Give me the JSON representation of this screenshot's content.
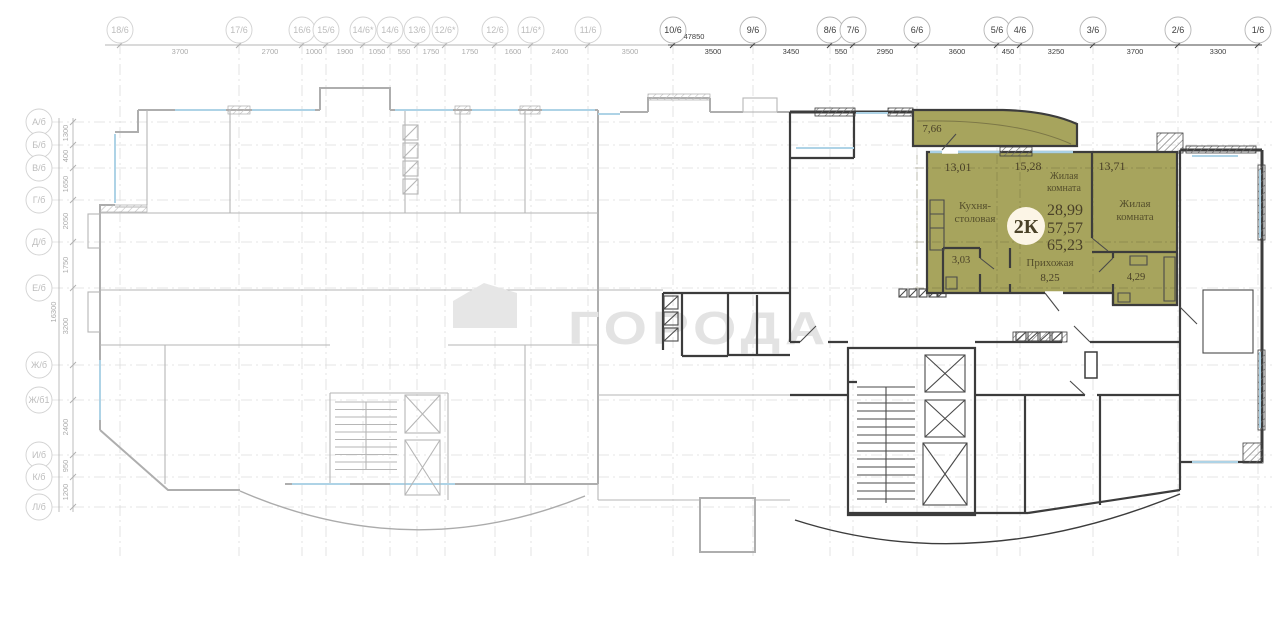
{
  "watermark": {
    "text": "ГОРОДА"
  },
  "colors": {
    "highlight": "#a7a45d",
    "badge_bg": "#fcf5e6",
    "label_text": "#4a4128",
    "glazing": "#aed3e6",
    "walls_dark": "#3c3c3c",
    "walls_gray": "#aeaeae"
  },
  "apartment": {
    "badge": "2К",
    "areas": {
      "living": "28,99",
      "total": "57,57",
      "full": "65,23"
    },
    "rooms": {
      "balcony": {
        "area": "7,66"
      },
      "kitchen": {
        "line1": "Кухня-",
        "line2": "столовая",
        "area": "13,01"
      },
      "living_mid": {
        "line1": "Жилая",
        "line2": "комната",
        "area": "15,28"
      },
      "living_right": {
        "line1": "Жилая",
        "line2": "комната",
        "area": "13,71"
      },
      "hall": {
        "name": "Прихожая",
        "area": "8,25"
      },
      "wc_left": {
        "area": "3,03"
      },
      "wc_right": {
        "area": "4,29"
      }
    }
  },
  "grid": {
    "top_total": "47850",
    "left_total": "16300",
    "top_axes": [
      {
        "label": "18/6",
        "x": 120,
        "dark": false
      },
      {
        "label": "17/6",
        "x": 239,
        "dark": false
      },
      {
        "label": "16/6",
        "x": 302,
        "dark": false
      },
      {
        "label": "15/6",
        "x": 326,
        "dark": false
      },
      {
        "label": "14/6*",
        "x": 363,
        "dark": false
      },
      {
        "label": "14/6",
        "x": 390,
        "dark": false
      },
      {
        "label": "13/6",
        "x": 417,
        "dark": false
      },
      {
        "label": "12/6*",
        "x": 445,
        "dark": false
      },
      {
        "label": "12/6",
        "x": 495,
        "dark": false
      },
      {
        "label": "11/6*",
        "x": 531,
        "dark": false
      },
      {
        "label": "11/6",
        "x": 588,
        "dark": false
      },
      {
        "label": "10/6",
        "x": 673,
        "dark": true
      },
      {
        "label": "9/6",
        "x": 753,
        "dark": true
      },
      {
        "label": "8/6",
        "x": 830,
        "dark": true
      },
      {
        "label": "7/6",
        "x": 853,
        "dark": true
      },
      {
        "label": "6/6",
        "x": 917,
        "dark": true
      },
      {
        "label": "5/6",
        "x": 997,
        "dark": true
      },
      {
        "label": "4/6",
        "x": 1020,
        "dark": true
      },
      {
        "label": "3/6",
        "x": 1093,
        "dark": true
      },
      {
        "label": "2/6",
        "x": 1178,
        "dark": true
      },
      {
        "label": "1/6",
        "x": 1258,
        "dark": true
      }
    ],
    "top_dims": [
      {
        "value": "3700",
        "x": 180,
        "dark": false
      },
      {
        "value": "2700",
        "x": 270,
        "dark": false
      },
      {
        "value": "1000",
        "x": 314,
        "dark": false
      },
      {
        "value": "1900",
        "x": 345,
        "dark": false
      },
      {
        "value": "1050",
        "x": 377,
        "dark": false
      },
      {
        "value": "550",
        "x": 404,
        "dark": false
      },
      {
        "value": "1750",
        "x": 431,
        "dark": false
      },
      {
        "value": "1750",
        "x": 470,
        "dark": false
      },
      {
        "value": "1600",
        "x": 513,
        "dark": false
      },
      {
        "value": "2400",
        "x": 560,
        "dark": false
      },
      {
        "value": "3500",
        "x": 630,
        "dark": false
      },
      {
        "value": "3500",
        "x": 713,
        "dark": true
      },
      {
        "value": "3450",
        "x": 791,
        "dark": true
      },
      {
        "value": "550",
        "x": 841,
        "dark": true
      },
      {
        "value": "2950",
        "x": 885,
        "dark": true
      },
      {
        "value": "3600",
        "x": 957,
        "dark": true
      },
      {
        "value": "450",
        "x": 1008,
        "dark": true
      },
      {
        "value": "3250",
        "x": 1056,
        "dark": true
      },
      {
        "value": "3700",
        "x": 1135,
        "dark": true
      },
      {
        "value": "3300",
        "x": 1218,
        "dark": true
      }
    ],
    "left_axes": [
      {
        "label": "А/б",
        "y": 122
      },
      {
        "label": "Б/б",
        "y": 145
      },
      {
        "label": "В/б",
        "y": 168
      },
      {
        "label": "Г/б",
        "y": 200
      },
      {
        "label": "Д/б",
        "y": 242
      },
      {
        "label": "Е/б",
        "y": 288
      },
      {
        "label": "Ж/б",
        "y": 365
      },
      {
        "label": "Ж/б1",
        "y": 400
      },
      {
        "label": "И/б",
        "y": 455
      },
      {
        "label": "К/б",
        "y": 477
      },
      {
        "label": "Л/б",
        "y": 507
      }
    ],
    "left_dims": [
      {
        "value": "1300",
        "y": 133
      },
      {
        "value": "400",
        "y": 156
      },
      {
        "value": "1650",
        "y": 184
      },
      {
        "value": "2050",
        "y": 221
      },
      {
        "value": "1750",
        "y": 265
      },
      {
        "value": "3200",
        "y": 326
      },
      {
        "value": "2400",
        "y": 427
      },
      {
        "value": "950",
        "y": 466
      },
      {
        "value": "1200",
        "y": 492
      }
    ]
  }
}
